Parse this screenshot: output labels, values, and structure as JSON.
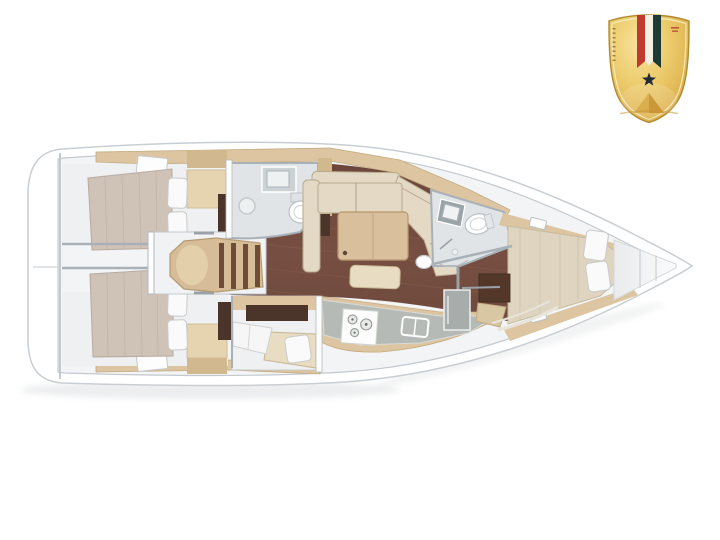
{
  "scene": {
    "type": "yacht-interior-floor-plan",
    "orientation": "bow-right",
    "regions": [
      "aft-cabin-port",
      "aft-cabin-starboard",
      "companionway-steps",
      "aft-head",
      "saloon",
      "saloon-table",
      "galley",
      "mid-cabin-berth",
      "forward-head",
      "forward-cabin",
      "bow-locker"
    ]
  },
  "badge": {
    "shape": "gold-shield",
    "elements": [
      "tricolor-ribbon",
      "star",
      "pyramid"
    ]
  },
  "palette": {
    "hull_white": "#ffffff",
    "hull_outline": "#c9ced3",
    "deck_line": "#c3c9ce",
    "interior_floor": "#f3f4f5",
    "room_floor": "#eef0f1",
    "bath_floor": "#e0e4e6",
    "wall_gray": "#a9b1b8",
    "wall_white": "#fdfdfd",
    "saloon_floor": "#714c3f",
    "plank_streak": "#8f6553",
    "wood_light": "#dcc5a0",
    "wood_mid": "#d2b88e",
    "wood_pale": "#e6d4b0",
    "wood_dark": "#4b3429",
    "mattress": "#cfc2b7",
    "mattress_fwd": "#ded4c0",
    "cushion": "#e3d9c4",
    "cushion_edge": "#b7a98e",
    "table_wood": "#d9bf9b",
    "bench_wood": "#e8dcc2",
    "pillow": "#fafafa",
    "pillow_edge": "#c9c9c9",
    "steps_wood": "#d6bd97",
    "step_stripe": "#6e4c36",
    "fixture_gray": "#ccd1d3",
    "fixture_white": "#ffffff",
    "counter_gray": "#b5bab6",
    "appliance_gray": "#a7adaa",
    "dresser_brown": "#53382a",
    "badge_gold_light": "#f7e098",
    "badge_gold": "#ecc968",
    "badge_gold_dark": "#c08c2d",
    "badge_border": "#b08a2e",
    "ribbon_red": "#bf3a31",
    "ribbon_white": "#f2efe4",
    "ribbon_green": "#1e3a33",
    "star_dark": "#232c36",
    "pyramid": "#cf9a33"
  }
}
